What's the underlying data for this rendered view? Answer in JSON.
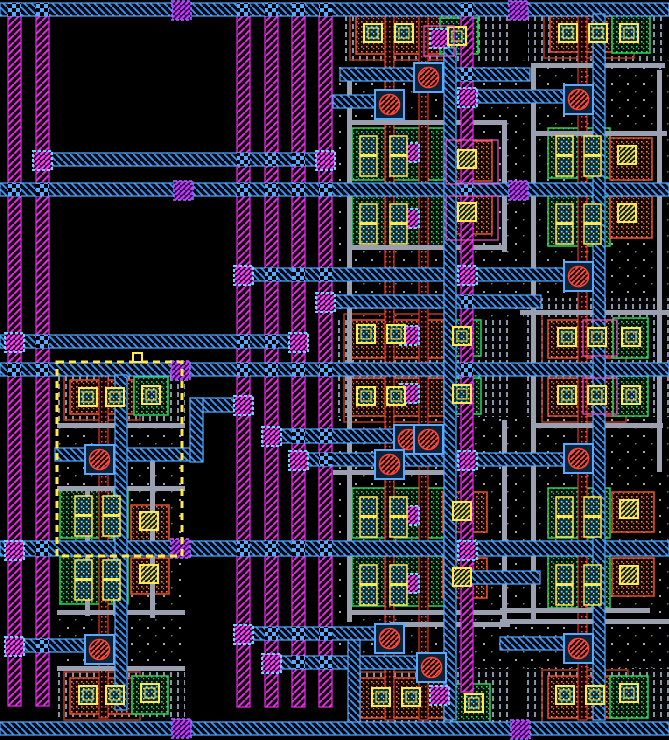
{
  "app": {
    "title": "vlsi-layout-canvas"
  },
  "canvas": {
    "width": 669,
    "height": 740,
    "background": "#000000"
  },
  "palette": {
    "metal2": "#f02cf0",
    "metal2_bright": "#ff3cff",
    "metal1": "#58aaff",
    "metal1_line": "#3d97f5",
    "poly_red": "#ff4433",
    "li_grey": "#9aa0b0",
    "diff_green": "#2bd35b",
    "diff_orange": "#e8502a",
    "contact_yellow": "#ffe94d",
    "contact_cyan": "#54d9ff",
    "via_purple_fill": "#2b2bd0",
    "via_purple_stroke": "#b06cff",
    "select_yellow": "#ffe94d",
    "well_stripe": "#8a92a6",
    "well_dot": "#9aa4b8"
  },
  "layout": {
    "wells_dotted": [
      [
        57,
        426,
        128,
        242
      ],
      [
        333,
        60,
        200,
        260
      ],
      [
        333,
        415,
        200,
        255
      ],
      [
        515,
        60,
        154,
        238
      ],
      [
        515,
        415,
        154,
        257
      ]
    ],
    "wells_striped": [
      [
        57,
        366,
        128,
        58
      ],
      [
        57,
        668,
        128,
        52
      ],
      [
        345,
        14,
        163,
        50
      ],
      [
        333,
        318,
        175,
        99
      ],
      [
        347,
        668,
        161,
        54
      ],
      [
        528,
        14,
        136,
        50
      ],
      [
        524,
        298,
        145,
        119
      ],
      [
        526,
        668,
        143,
        52
      ]
    ],
    "cells": [
      {
        "k": "pm",
        "r": [
          70,
          380,
          64,
          34
        ]
      },
      {
        "k": "gn",
        "r": [
          134,
          377,
          34,
          38
        ]
      },
      {
        "k": "nm",
        "r": [
          60,
          490,
          68,
          48
        ]
      },
      {
        "k": "or",
        "r": [
          131,
          505,
          38,
          36
        ]
      },
      {
        "k": "nm",
        "r": [
          60,
          556,
          68,
          48
        ]
      },
      {
        "k": "or",
        "r": [
          131,
          558,
          38,
          36
        ]
      },
      {
        "k": "pm",
        "r": [
          70,
          678,
          64,
          36
        ]
      },
      {
        "k": "gn",
        "r": [
          132,
          676,
          36,
          38
        ]
      },
      {
        "k": "pm",
        "r": [
          356,
          16,
          92,
          38
        ]
      },
      {
        "k": "gn",
        "r": [
          440,
          18,
          38,
          36
        ]
      },
      {
        "k": "nm",
        "r": [
          352,
          128,
          96,
          52
        ]
      },
      {
        "k": "or",
        "r": [
          448,
          141,
          44,
          40
        ]
      },
      {
        "k": "nm",
        "r": [
          352,
          194,
          96,
          52
        ]
      },
      {
        "k": "or",
        "r": [
          448,
          194,
          44,
          40
        ]
      },
      {
        "k": "pm",
        "r": [
          350,
          320,
          94,
          38
        ]
      },
      {
        "k": "gn",
        "r": [
          445,
          320,
          36,
          36
        ]
      },
      {
        "k": "pm",
        "r": [
          350,
          378,
          94,
          38
        ]
      },
      {
        "k": "gn",
        "r": [
          445,
          378,
          36,
          36
        ]
      },
      {
        "k": "nm",
        "r": [
          352,
          488,
          96,
          50
        ]
      },
      {
        "k": "or",
        "r": [
          443,
          492,
          44,
          40
        ]
      },
      {
        "k": "nm",
        "r": [
          352,
          556,
          96,
          50
        ]
      },
      {
        "k": "or",
        "r": [
          443,
          558,
          44,
          40
        ]
      },
      {
        "k": "pm",
        "r": [
          360,
          678,
          88,
          40
        ]
      },
      {
        "k": "gn",
        "r": [
          452,
          684,
          38,
          38
        ]
      },
      {
        "k": "pm",
        "r": [
          550,
          16,
          78,
          36
        ]
      },
      {
        "k": "gn",
        "r": [
          612,
          15,
          38,
          38
        ]
      },
      {
        "k": "nm",
        "r": [
          548,
          128,
          62,
          50
        ]
      },
      {
        "k": "or",
        "r": [
          610,
          138,
          42,
          42
        ]
      },
      {
        "k": "nm",
        "r": [
          548,
          194,
          62,
          52
        ]
      },
      {
        "k": "or",
        "r": [
          610,
          196,
          42,
          42
        ]
      },
      {
        "k": "pm",
        "r": [
          548,
          320,
          72,
          38
        ]
      },
      {
        "k": "gn",
        "r": [
          613,
          318,
          35,
          40
        ]
      },
      {
        "k": "pm",
        "r": [
          548,
          378,
          72,
          38
        ]
      },
      {
        "k": "gn",
        "r": [
          613,
          376,
          35,
          40
        ]
      },
      {
        "k": "nm",
        "r": [
          548,
          488,
          62,
          50
        ]
      },
      {
        "k": "or",
        "r": [
          612,
          492,
          42,
          40
        ]
      },
      {
        "k": "nm",
        "r": [
          548,
          556,
          62,
          52
        ]
      },
      {
        "k": "or",
        "r": [
          612,
          558,
          42,
          38
        ]
      },
      {
        "k": "pm",
        "r": [
          548,
          676,
          74,
          42
        ]
      },
      {
        "k": "gn",
        "r": [
          610,
          676,
          38,
          42
        ]
      }
    ],
    "poly_columns": [
      [
        99,
        370,
        9,
        348
      ],
      [
        385,
        14,
        9,
        706
      ],
      [
        419,
        14,
        9,
        706
      ],
      [
        578,
        14,
        9,
        706
      ]
    ],
    "li_horizontal": [
      [
        57,
        423,
        128,
        5
      ],
      [
        57,
        486,
        128,
        5
      ],
      [
        57,
        610,
        128,
        5
      ],
      [
        57,
        666,
        128,
        5
      ],
      [
        347,
        120,
        158,
        5
      ],
      [
        347,
        245,
        158,
        5
      ],
      [
        333,
        470,
        120,
        5
      ],
      [
        347,
        610,
        160,
        5
      ],
      [
        390,
        622,
        120,
        5
      ],
      [
        533,
        63,
        132,
        5
      ],
      [
        533,
        131,
        134,
        5
      ],
      [
        520,
        310,
        149,
        5
      ],
      [
        533,
        423,
        130,
        5
      ],
      [
        500,
        608,
        150,
        5
      ],
      [
        500,
        619,
        169,
        5
      ]
    ],
    "li_vertical": [
      [
        85,
        486,
        5,
        130
      ],
      [
        113,
        486,
        5,
        130
      ],
      [
        150,
        450,
        5,
        168
      ],
      [
        347,
        68,
        5,
        554
      ],
      [
        502,
        120,
        5,
        132
      ],
      [
        502,
        420,
        5,
        200
      ],
      [
        531,
        63,
        5,
        560
      ],
      [
        657,
        70,
        5,
        402
      ]
    ],
    "m2_rails": [
      [
        8,
        3,
        13,
        703
      ],
      [
        36,
        3,
        13,
        703
      ],
      [
        237,
        3,
        13,
        704
      ],
      [
        265,
        3,
        13,
        704
      ],
      [
        292,
        3,
        13,
        704
      ],
      [
        319,
        3,
        13,
        704
      ],
      [
        461,
        3,
        12,
        689
      ]
    ],
    "m1_buses": [
      [
        0,
        3,
        669,
        13
      ],
      [
        340,
        68,
        190,
        13
      ],
      [
        333,
        95,
        62,
        13
      ],
      [
        455,
        90,
        128,
        13
      ],
      [
        36,
        153,
        296,
        13
      ],
      [
        0,
        183,
        669,
        13
      ],
      [
        237,
        268,
        346,
        13
      ],
      [
        319,
        295,
        222,
        13
      ],
      [
        0,
        335,
        307,
        13
      ],
      [
        0,
        363,
        669,
        13
      ],
      [
        190,
        398,
        60,
        14
      ],
      [
        265,
        429,
        175,
        14
      ],
      [
        292,
        453,
        291,
        13
      ],
      [
        55,
        448,
        148,
        13
      ],
      [
        0,
        541,
        669,
        15
      ],
      [
        465,
        571,
        75,
        13
      ],
      [
        500,
        637,
        68,
        13
      ],
      [
        237,
        627,
        158,
        13
      ],
      [
        265,
        656,
        167,
        13
      ],
      [
        8,
        639,
        95,
        13
      ],
      [
        0,
        722,
        669,
        13
      ]
    ],
    "m1_verticals": [
      [
        115,
        375,
        12,
        335
      ],
      [
        444,
        48,
        12,
        672
      ],
      [
        593,
        14,
        12,
        706
      ],
      [
        190,
        398,
        13,
        64
      ],
      [
        348,
        640,
        12,
        82
      ]
    ],
    "vias_m2": [
      [
        33,
        151
      ],
      [
        316,
        151
      ],
      [
        234,
        266
      ],
      [
        458,
        266
      ],
      [
        316,
        293
      ],
      [
        458,
        88
      ],
      [
        5,
        333
      ],
      [
        289,
        333
      ],
      [
        5,
        541
      ],
      [
        458,
        541
      ],
      [
        234,
        625
      ],
      [
        262,
        654
      ],
      [
        5,
        637
      ],
      [
        234,
        396
      ],
      [
        262,
        427
      ],
      [
        289,
        451
      ],
      [
        458,
        451
      ],
      [
        430,
        29
      ],
      [
        400,
        143
      ],
      [
        400,
        209
      ],
      [
        400,
        326
      ],
      [
        400,
        384
      ],
      [
        400,
        506
      ],
      [
        400,
        574
      ],
      [
        430,
        686
      ]
    ],
    "vias_purple": [
      [
        172,
        1
      ],
      [
        509,
        1
      ],
      [
        174,
        181
      ],
      [
        509,
        181
      ],
      [
        171,
        361
      ],
      [
        171,
        539
      ],
      [
        172,
        719
      ],
      [
        511,
        720
      ]
    ],
    "poly_contacts": [
      [
        414,
        63
      ],
      [
        375,
        90
      ],
      [
        564,
        85
      ],
      [
        564,
        262
      ],
      [
        85,
        445
      ],
      [
        394,
        425
      ],
      [
        414,
        425
      ],
      [
        375,
        450
      ],
      [
        564,
        444
      ],
      [
        85,
        635
      ],
      [
        375,
        624
      ],
      [
        417,
        653
      ],
      [
        564,
        634
      ]
    ],
    "contacts_speckle": [
      [
        79,
        388
      ],
      [
        106,
        388
      ],
      [
        142,
        386
      ],
      [
        79,
        686
      ],
      [
        106,
        686
      ],
      [
        141,
        684
      ],
      [
        364,
        24
      ],
      [
        395,
        24
      ],
      [
        448,
        27
      ],
      [
        357,
        325
      ],
      [
        387,
        325
      ],
      [
        453,
        327
      ],
      [
        357,
        387
      ],
      [
        387,
        387
      ],
      [
        453,
        385
      ],
      [
        372,
        688
      ],
      [
        402,
        688
      ],
      [
        465,
        694
      ],
      [
        559,
        24
      ],
      [
        589,
        24
      ],
      [
        620,
        24
      ],
      [
        558,
        328
      ],
      [
        588,
        328
      ],
      [
        622,
        328
      ],
      [
        558,
        386
      ],
      [
        588,
        386
      ],
      [
        622,
        386
      ],
      [
        556,
        686
      ],
      [
        586,
        686
      ],
      [
        620,
        684
      ]
    ],
    "contacts_diag": [
      [
        140,
        512
      ],
      [
        140,
        565
      ],
      [
        458,
        150
      ],
      [
        458,
        203
      ],
      [
        453,
        502
      ],
      [
        453,
        568
      ],
      [
        618,
        146
      ],
      [
        618,
        204
      ],
      [
        620,
        500
      ],
      [
        620,
        566
      ]
    ],
    "contact_columns": [
      [
        75,
        496
      ],
      [
        103,
        496
      ],
      [
        75,
        560
      ],
      [
        103,
        560
      ],
      [
        360,
        136
      ],
      [
        390,
        136
      ],
      [
        360,
        204
      ],
      [
        390,
        204
      ],
      [
        360,
        497
      ],
      [
        390,
        497
      ],
      [
        360,
        565
      ],
      [
        390,
        565
      ],
      [
        556,
        136
      ],
      [
        584,
        136
      ],
      [
        556,
        204
      ],
      [
        584,
        204
      ],
      [
        556,
        497
      ],
      [
        584,
        497
      ],
      [
        556,
        565
      ],
      [
        584,
        565
      ]
    ],
    "pink_frames": [
      [
        583,
        320,
        34,
        36
      ],
      [
        583,
        378,
        34,
        36
      ],
      [
        446,
        140,
        52,
        44
      ],
      [
        446,
        196,
        52,
        44
      ],
      [
        424,
        26,
        30,
        30
      ]
    ],
    "selection": {
      "box": [
        57,
        362,
        125,
        194
      ],
      "handle": [
        133,
        353,
        9,
        9
      ]
    }
  }
}
